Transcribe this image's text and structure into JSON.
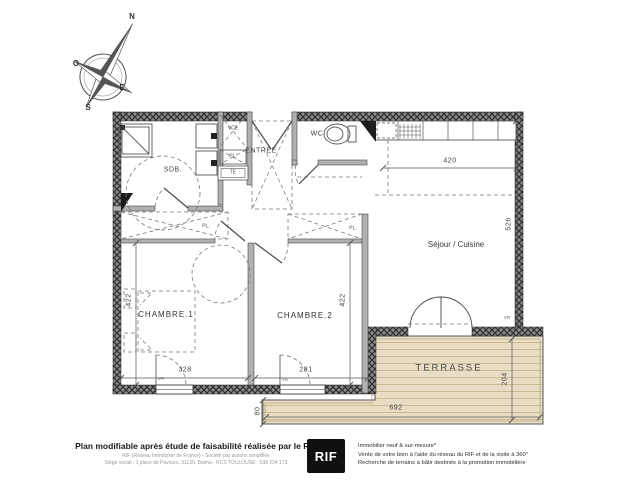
{
  "compass": {
    "n": "N",
    "o": "O",
    "e": "E",
    "s": "S"
  },
  "plan": {
    "rooms": {
      "sdb": "SDB.",
      "entree": "ENTRÉE",
      "wc": "WC",
      "sejour": "Séjour / Cuisine",
      "chambre1": "CHAMBRE.1",
      "chambre2": "CHAMBRE.2",
      "terrasse": "TERRASSE"
    },
    "closets": {
      "vce": "VCE",
      "pl_entree": "PL.",
      "te": "TE",
      "pl_ch1": "PL.",
      "pl_ch2": "PL."
    },
    "dims": {
      "kitchen_width": "420",
      "sejour_height": "526",
      "ch1_height": "422",
      "ch2_height": "422",
      "ch1_width": "328",
      "ch2_width": "281",
      "terrasse_width": "692",
      "terrasse_height": "204",
      "terrasse_side": "80"
    },
    "vr": "VR"
  },
  "colors": {
    "wall_dark": "#303030",
    "partition_gray": "#b0b0b0",
    "terrace_wood": "#e9dec5",
    "logo_bg": "#101010"
  },
  "footer": {
    "title": "Plan modifiable après étude de faisabilité réalisée par le RIF",
    "sub1": "RIF (Réseau Immobilier de France) - Société par actions simplifiée",
    "sub2": "Siège social : 1 place de Pavours, 31130, Balma - RCS TOULOUSE : 538 234 173",
    "logo": "RIF",
    "right1": "Immobilier neuf & sur-mesure*",
    "right2": "Vente de votre bien à l'aide du réseau du RIF et de la visite à 360°",
    "right3": "Recherche de terrains à bâtir destinés à la promotion immobilière"
  }
}
